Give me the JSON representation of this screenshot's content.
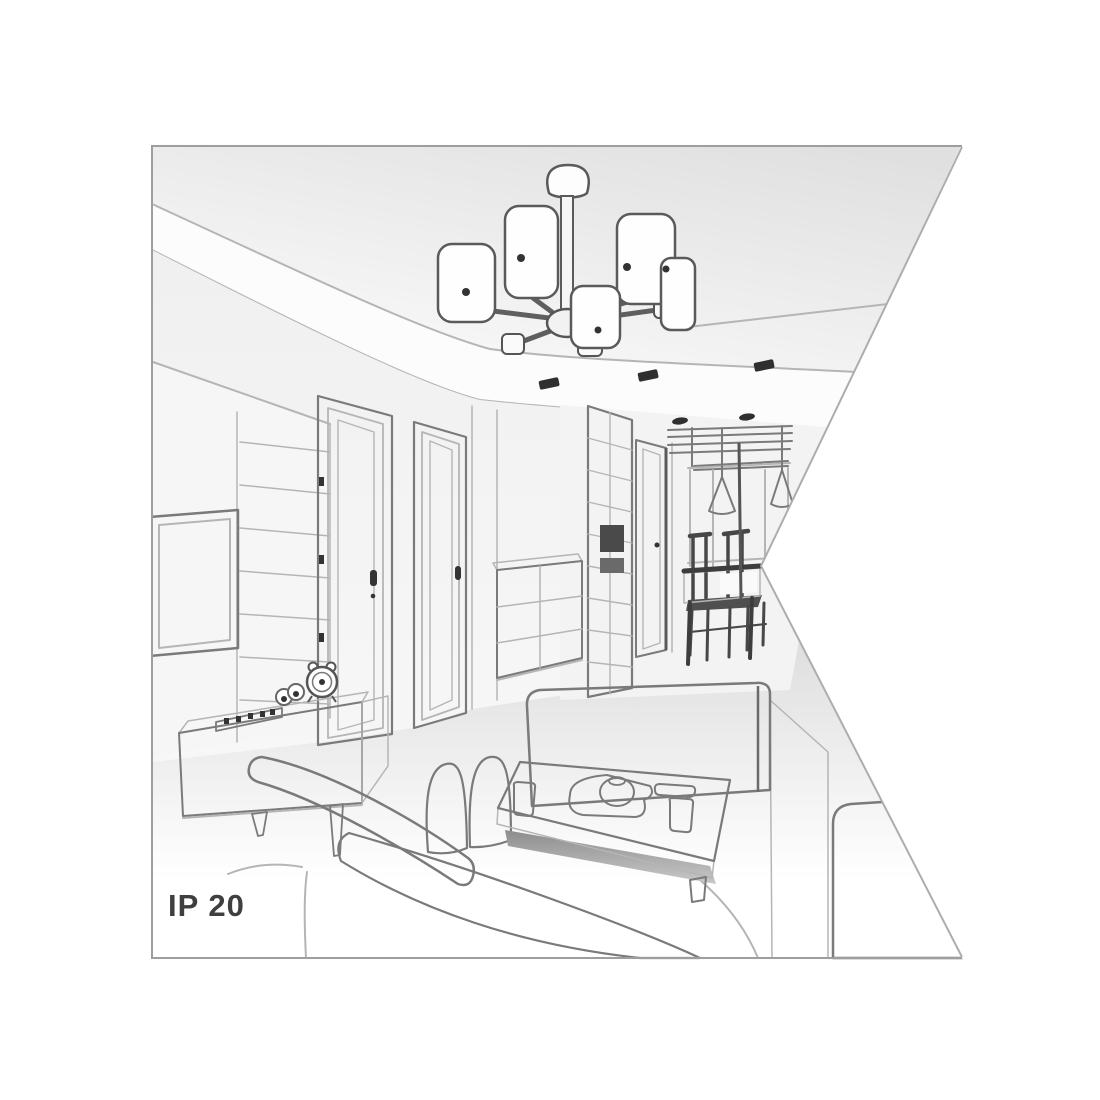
{
  "illustration": {
    "label": "IP 20",
    "kind": "interior-room-line-drawing"
  },
  "palette": {
    "bg": "#ffffff",
    "line": "#7a7a7a",
    "line-dark": "#4f4f4f",
    "line-light": "#b5b5b5",
    "dark": "#333333",
    "wall": "#f4f4f4",
    "label": "#3f3f3f",
    "border": "#9e9e9e",
    "ceiling-shade": "#e2e2e2",
    "floor-shade": "#d6d6d6",
    "shadow": "#8d8d8d"
  },
  "scene_objects": [
    "ceiling-chandelier-with-cylinder-shades",
    "ceiling-spotlights",
    "recessed-ceiling-panel",
    "wall-tv-frame",
    "paneled-accent-wall",
    "interior-door-left",
    "interior-door-right",
    "hallway-wardrobe-grid-doors",
    "hallway-door",
    "chest-of-drawers",
    "dining-table-with-chairs",
    "pendant-cone-lamps",
    "window-mullions",
    "sideboard-tv-stand",
    "alarm-clock",
    "left-sofa",
    "right-sofa",
    "armchair",
    "coffee-table-with-tea-set"
  ]
}
